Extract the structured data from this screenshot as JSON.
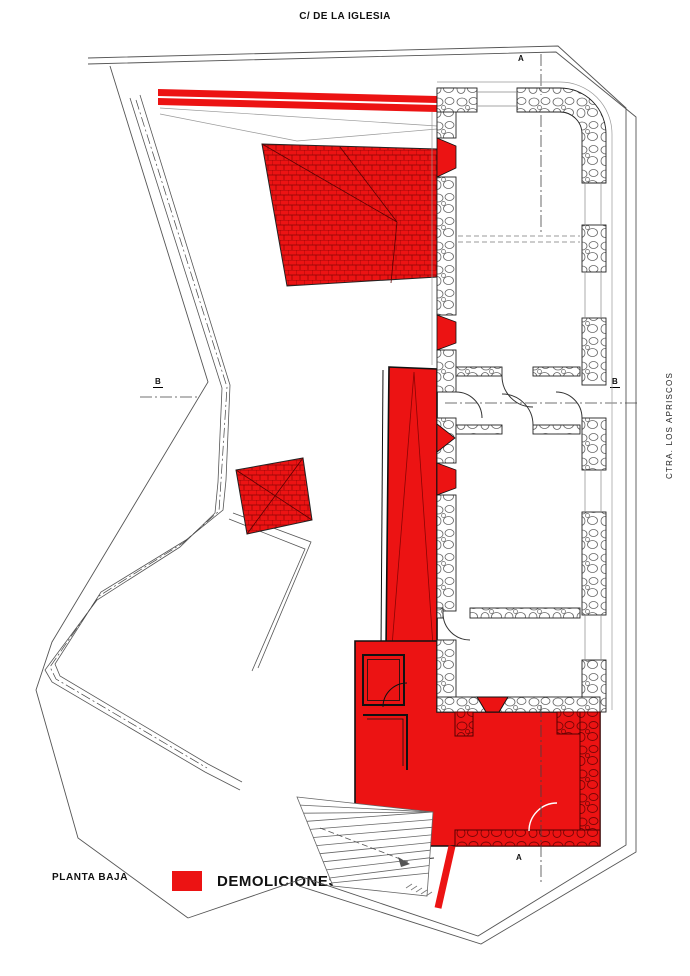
{
  "labels": {
    "street_top": "C/ DE LA IGLESIA",
    "road_right": "CTRA. LOS APRISCOS",
    "plan_name": "PLANTA BAJA"
  },
  "legend": {
    "label": "DEMOLICIONES",
    "color": "#EC1313"
  },
  "sections": {
    "a_top": "A",
    "a_bottom": "A",
    "b_left": "B",
    "b_right": "B"
  },
  "colors": {
    "demolition_red": "#EC1313",
    "tile_stroke_red": "#8A0404",
    "drawing_line": "#555555",
    "wall_outline": "#222222"
  }
}
